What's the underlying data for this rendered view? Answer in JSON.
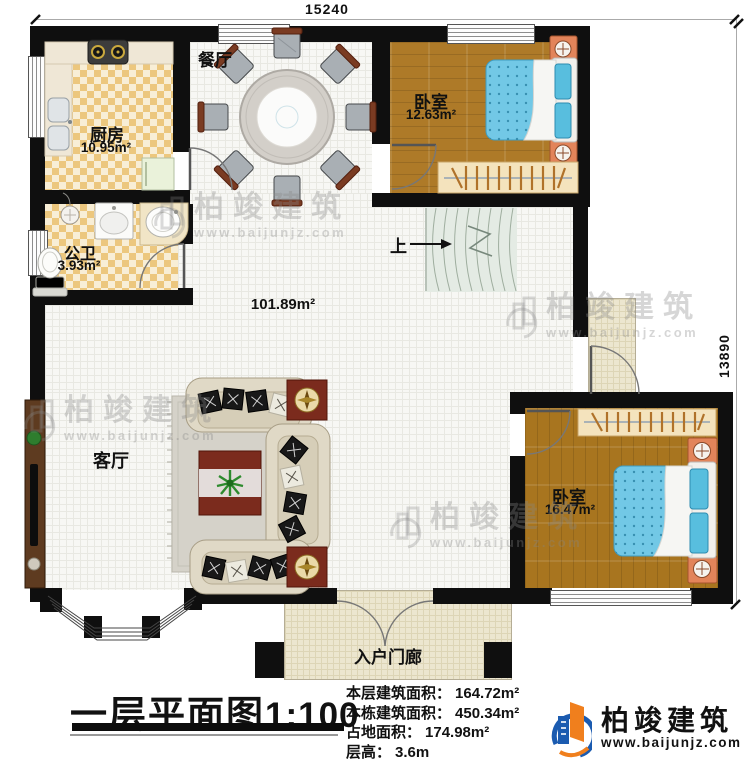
{
  "plan": {
    "dim_top": "15240",
    "dim_right": "13890",
    "rooms": {
      "dining": {
        "name": "餐厅"
      },
      "kitchen": {
        "name": "厨房",
        "area": "10.95m²"
      },
      "bath": {
        "name": "公卫",
        "area": "3.93m²"
      },
      "bedroom1": {
        "name": "卧室",
        "area": "12.63m²"
      },
      "living": {
        "name": "客厅",
        "area": "101.89m²"
      },
      "bedroom2": {
        "name": "卧室",
        "area": "16.47m²"
      },
      "porch": {
        "name": "入户门廊"
      },
      "stairs": {
        "up": "上"
      }
    }
  },
  "footer": {
    "title": "一层平面图",
    "scale": "1:100",
    "stats": [
      {
        "label": "本层建筑面积：",
        "value": "164.72m²"
      },
      {
        "label": "本栋建筑面积：",
        "value": "450.34m²"
      },
      {
        "label": "占地面积：",
        "value": "174.98m²"
      },
      {
        "label": "层高：",
        "value": "3.6m"
      }
    ]
  },
  "logo": {
    "name": "柏竣建筑",
    "website": "www.baijunjz.com"
  },
  "watermark": {
    "name": "柏竣建筑",
    "website": "www.baijunjz.com"
  },
  "colors": {
    "wall": "#0f0f0f",
    "wood": "#ae7a28",
    "bed_blue": "#6cc5e6",
    "checker": "#ecc77e",
    "porch": "#ece6cf",
    "logo_blue": "#1b5bb0",
    "logo_orange": "#f07f1d"
  }
}
